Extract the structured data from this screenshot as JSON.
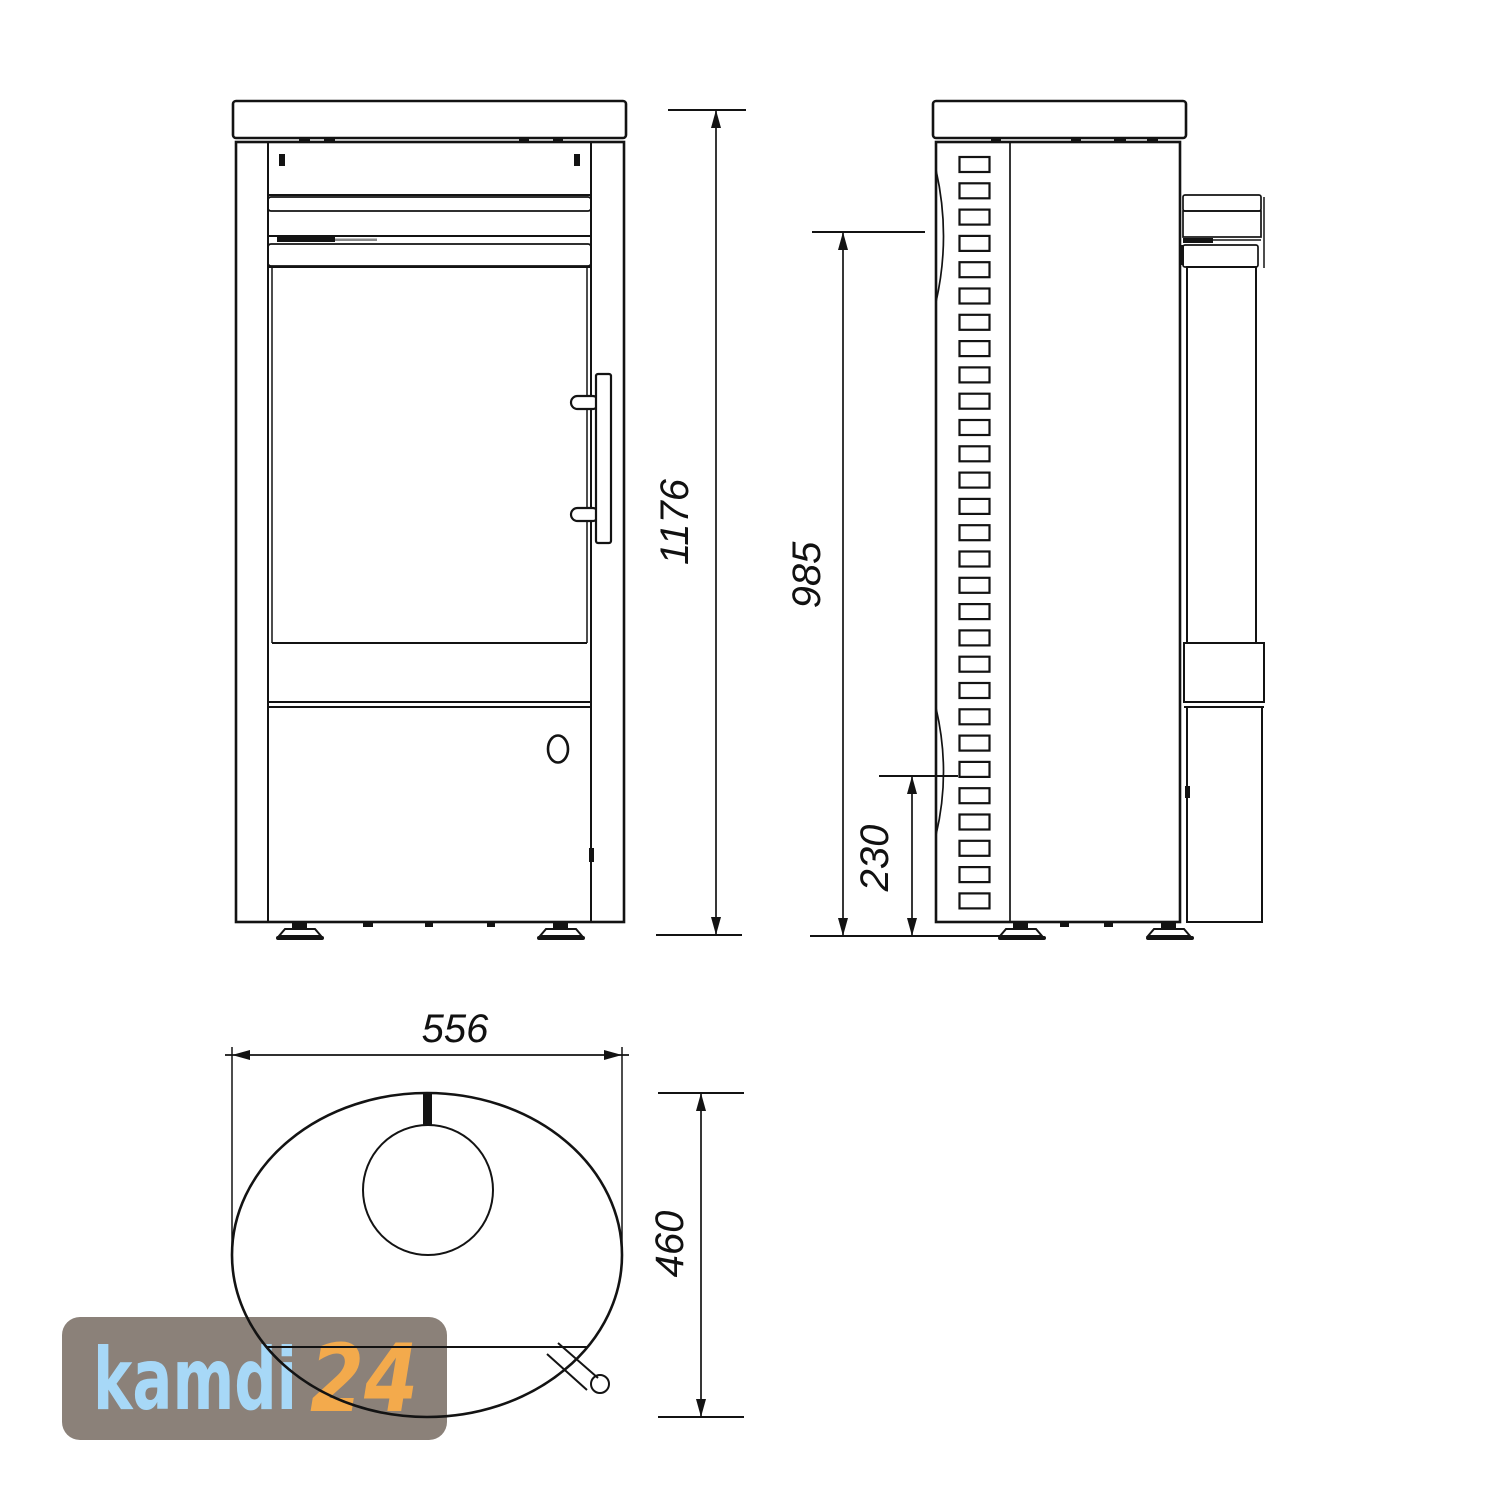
{
  "dimensions": {
    "total_height": "1176",
    "flue_height": "985",
    "base_height": "230",
    "width": "556",
    "depth": "460"
  },
  "watermark": {
    "brand": "kamdi",
    "number": "24",
    "bg_color": "#8b8179",
    "brand_color": "#a7d8f7",
    "number_color": "#f3aa4c"
  },
  "colors": {
    "line": "#131313",
    "background": "#ffffff"
  }
}
